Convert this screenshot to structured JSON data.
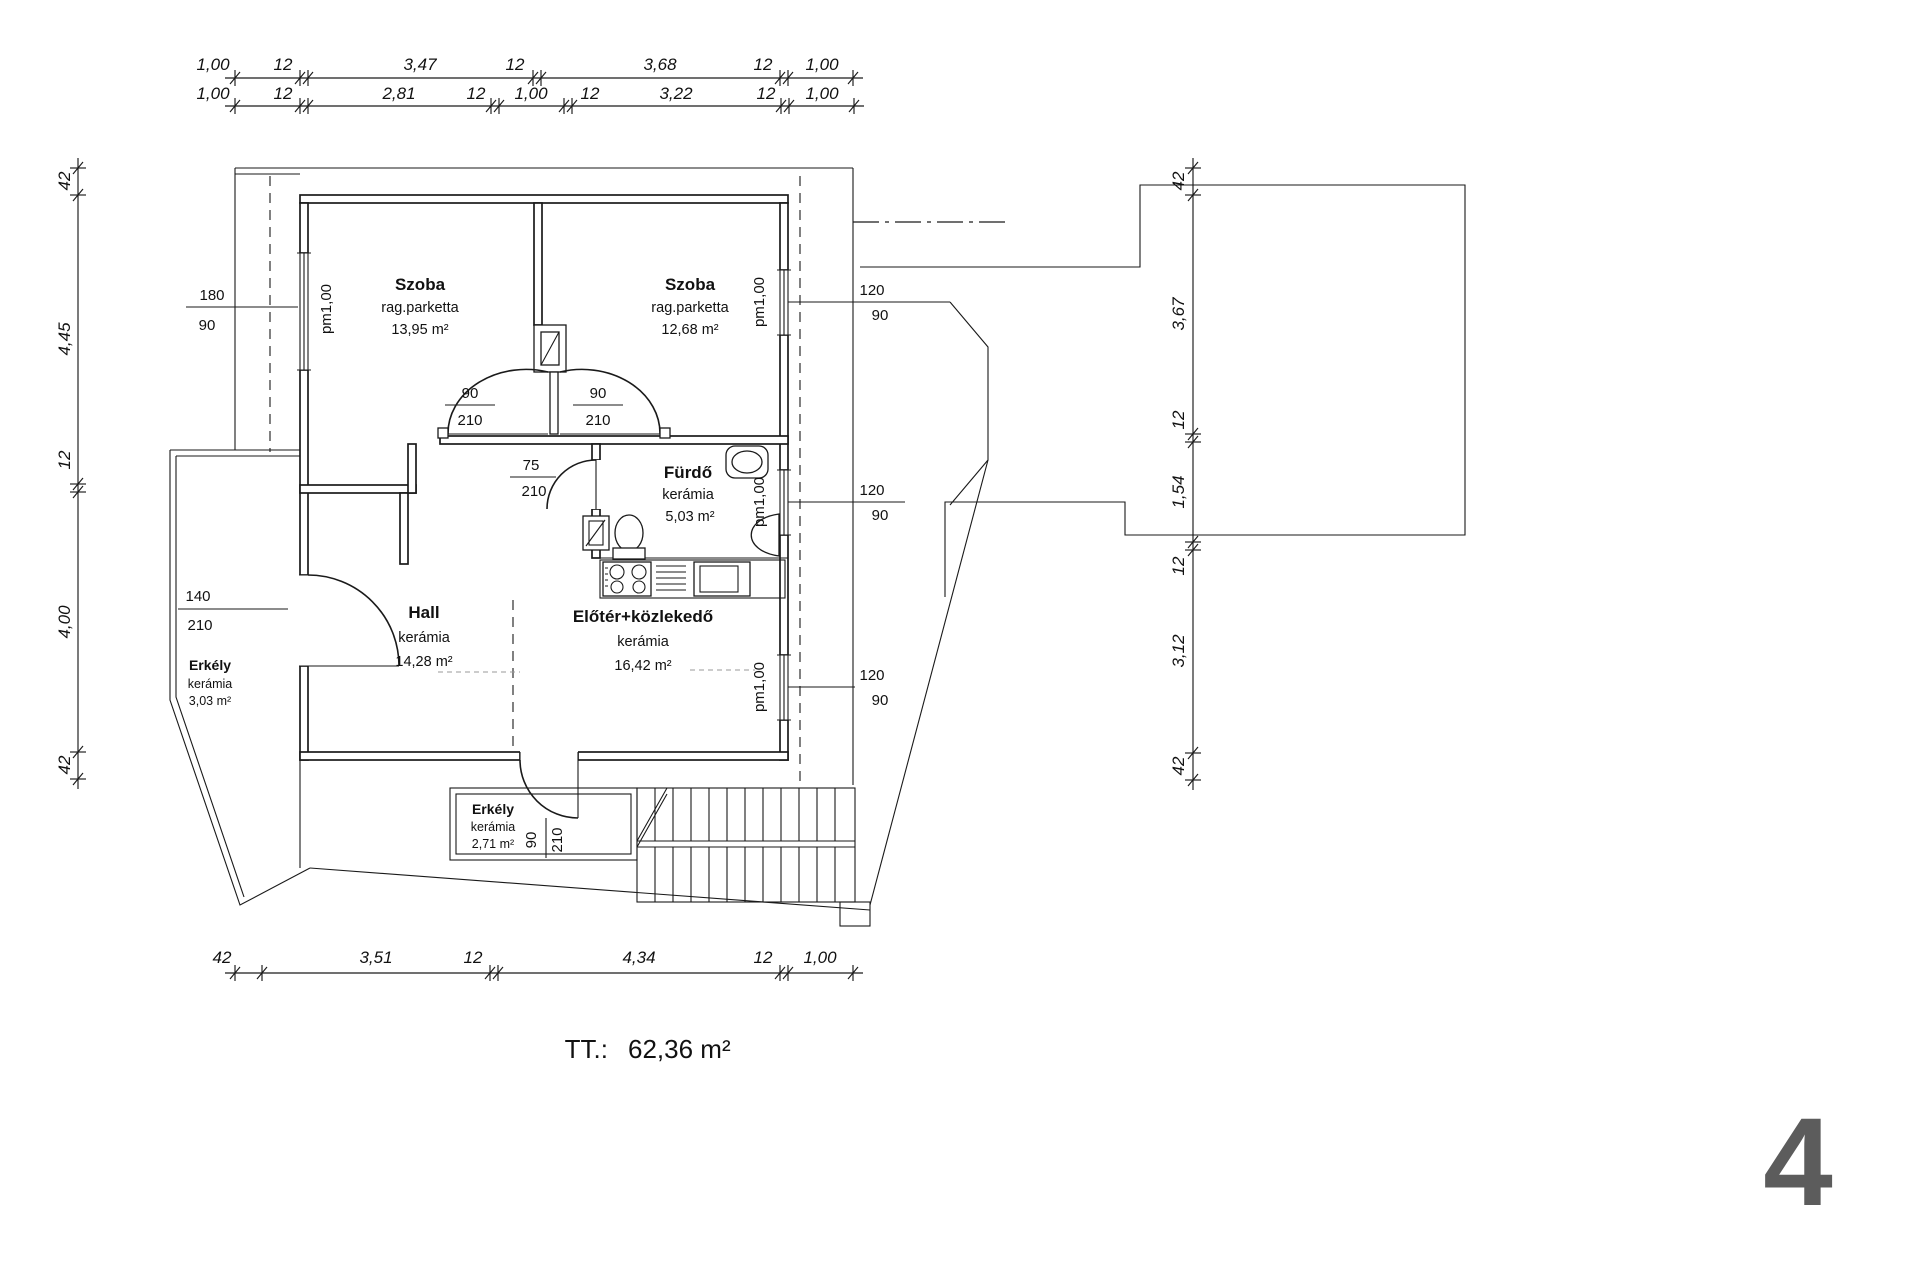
{
  "dims": {
    "top1": [
      "1,00",
      "12",
      "3,47",
      "12",
      "3,68",
      "12",
      "1,00"
    ],
    "top2": [
      "1,00",
      "12",
      "2,81",
      "12",
      "1,00",
      "12",
      "3,22",
      "12",
      "1,00"
    ],
    "left": [
      "42",
      "4,45",
      "12",
      "4,00",
      "42"
    ],
    "right": [
      "42",
      "3,67",
      "12",
      "1,54",
      "12",
      "3,12",
      "42"
    ],
    "bottom": [
      "42",
      "3,51",
      "12",
      "4,34",
      "12",
      "1,00"
    ]
  },
  "rooms": [
    {
      "name": "Szoba",
      "finish": "rag.parketta",
      "area": "13,95 m²"
    },
    {
      "name": "Szoba",
      "finish": "rag.parketta",
      "area": "12,68 m²"
    },
    {
      "name": "Fürdő",
      "finish": "kerámia",
      "area": "5,03 m²"
    },
    {
      "name": "Hall",
      "finish": "kerámia",
      "area": "14,28 m²"
    },
    {
      "name": "Előtér+közlekedő",
      "finish": "kerámia",
      "area": "16,42 m²"
    },
    {
      "name": "Erkély",
      "finish": "kerámia",
      "area": "3,03 m²"
    },
    {
      "name": "Erkély",
      "finish": "kerámia",
      "area": "2,71 m²"
    }
  ],
  "openings": {
    "window_left": {
      "w": "180",
      "h": "90",
      "parapet": "pm1,00"
    },
    "door_szoba1": {
      "w": "90",
      "h": "210"
    },
    "door_szoba2": {
      "w": "90",
      "h": "210"
    },
    "door_furdo": {
      "w": "75",
      "h": "210"
    },
    "door_erkely_left": {
      "w": "140",
      "h": "210"
    },
    "door_erkely_bottom": {
      "w": "90",
      "h": "210"
    },
    "window_right_1": {
      "w": "120",
      "h": "90",
      "parapet": "pm1,00"
    },
    "window_right_2": {
      "w": "120",
      "h": "90",
      "parapet": "pm1,00"
    },
    "window_right_3": {
      "w": "120",
      "h": "90",
      "parapet": "pm1,00"
    }
  },
  "summary": {
    "label": "TT.:",
    "value": "62,36 m²"
  },
  "page_number": "4",
  "colors": {
    "line": "#1a1a1a",
    "page_number": "#5c5c5c",
    "background": "#ffffff"
  }
}
